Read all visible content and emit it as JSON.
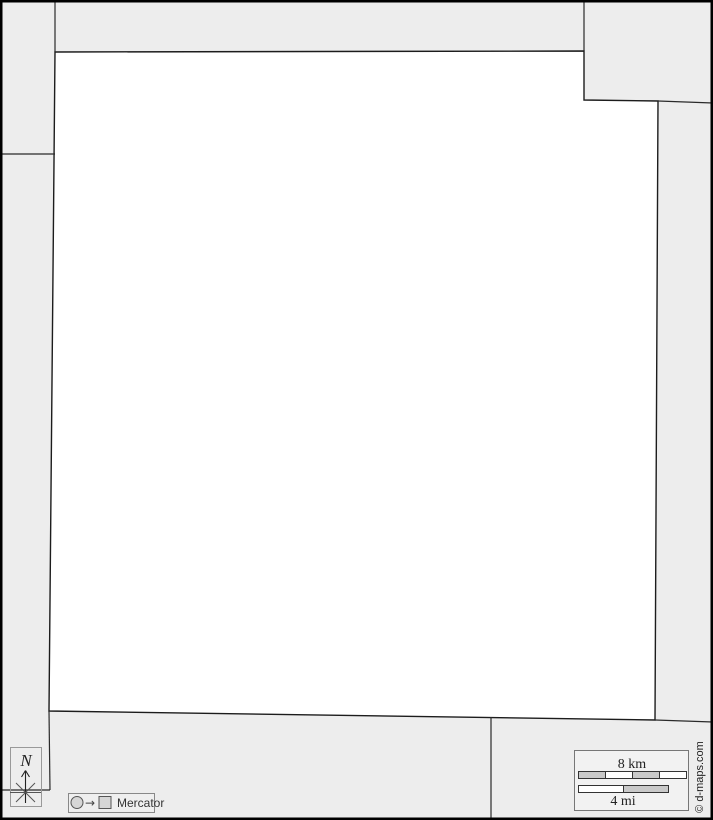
{
  "map": {
    "kind": "blank-outline-administrative-map",
    "background_color": "#EDEDED",
    "main_region_fill": "#FFFFFF",
    "boundary_color": "#1C1C1C",
    "outer_border_color": "#000000"
  },
  "compass": {
    "north_label": "N"
  },
  "projection_legend": {
    "from_icon": "circle",
    "to_icon": "square",
    "arrow_glyph": "→",
    "label": "Mercator"
  },
  "scale_bar": {
    "km_label": "8 km",
    "mi_label": "4 mi",
    "segment_fill": "#C9C9C9",
    "bar_fill": "#FFFFFF"
  },
  "credit": {
    "label": "© d-maps.com"
  }
}
